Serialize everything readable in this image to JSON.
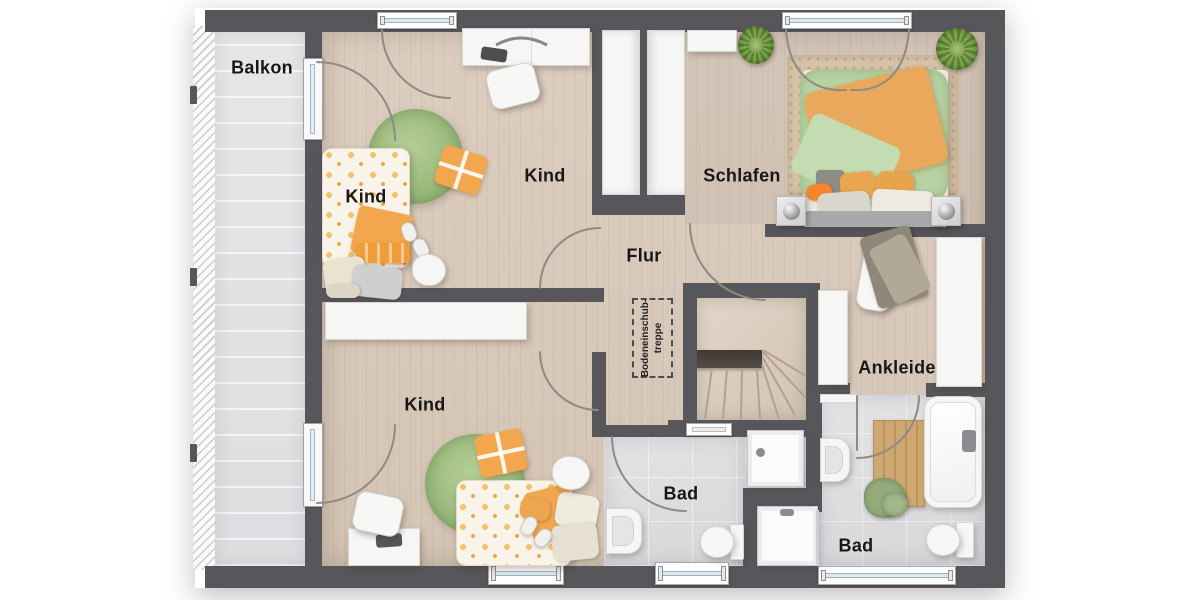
{
  "floorplan": {
    "rooms": {
      "balkon": {
        "label": "Balkon"
      },
      "kind_top": {
        "label_bed": "Kind",
        "label_room": "Kind"
      },
      "kind_bottom": {
        "label": "Kind"
      },
      "schlafen": {
        "label": "Schlafen"
      },
      "flur": {
        "label": "Flur"
      },
      "ankleide": {
        "label": "Ankleide"
      },
      "bad_left": {
        "label": "Bad"
      },
      "bad_right": {
        "label": "Bad"
      },
      "attic_hatch": {
        "line1": "Bodeneinschub-",
        "line2": "treppe"
      }
    },
    "colors": {
      "wall": "#57565a",
      "wood_floor": "#d8c9ba",
      "bath_floor": "#dedee1",
      "balcony_floor": "#ececee",
      "rug_green": "#9cba7e",
      "bed_green": "#b6d2a2",
      "accent_orange": "#f2a64e",
      "wood_mat": "#c8a271",
      "furniture_white": "#f6f6f5"
    }
  }
}
